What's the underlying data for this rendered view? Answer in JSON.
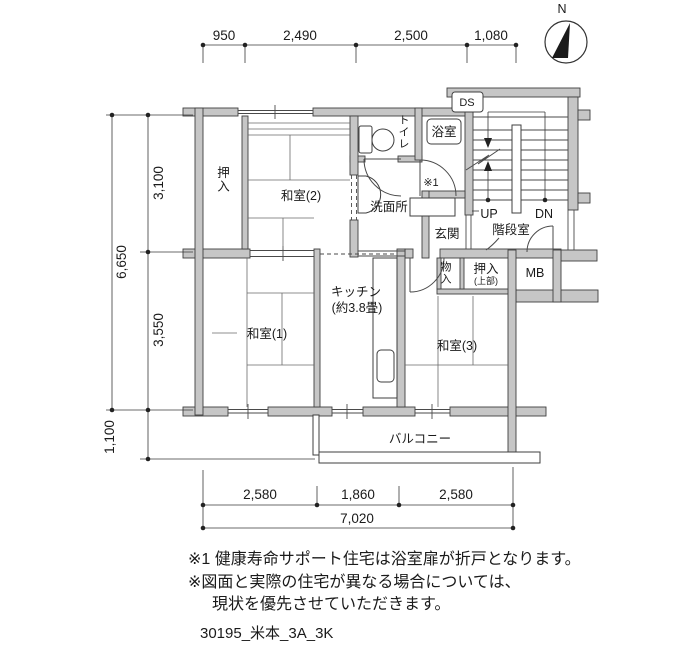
{
  "compass": {
    "north_label": "N"
  },
  "stairwell": {
    "label": "階段室",
    "up_label": "UP",
    "down_label": "DN",
    "duct_label": "DS"
  },
  "rooms": {
    "washitsu2": {
      "label": "和室(2)"
    },
    "washitsu1": {
      "label": "和室(1)"
    },
    "washitsu3": {
      "label": "和室(3)"
    },
    "kitchen": {
      "label": "キッチン",
      "size": "(約3.8畳)"
    },
    "oshiire_left": {
      "label": "押入"
    },
    "oshiire_upper": {
      "label": "押入",
      "sub": "(上部)"
    },
    "storage": {
      "label": "物入"
    },
    "toilet": {
      "label": "トイレ"
    },
    "bath": {
      "label": "浴室",
      "note_ref": "※1"
    },
    "washroom": {
      "label": "洗面所"
    },
    "genkan": {
      "label": "玄関"
    },
    "balcony": {
      "label": "バルコニー"
    },
    "meter_box": {
      "label": "MB"
    }
  },
  "dimensions": {
    "top": [
      "950",
      "2,490",
      "2,500",
      "1,080"
    ],
    "left_total": "6,650",
    "left": [
      "3,100",
      "3,550",
      "1,100"
    ],
    "bottom": [
      "2,580",
      "1,860",
      "2,580"
    ],
    "bottom_total": "7,020"
  },
  "notes": {
    "line1": "※1 健康寿命サポート住宅は浴室扉が折戸となります。",
    "line2": "※図面と実際の住宅が異なる場合については、",
    "line3": "現状を優先させていただきます。"
  },
  "drawing_id": "30195_米本_3A_3K",
  "colors": {
    "wall_fill": "#c6c6c6",
    "line": "#3a3a3a",
    "text": "#1a1a1a",
    "background": "#ffffff"
  }
}
